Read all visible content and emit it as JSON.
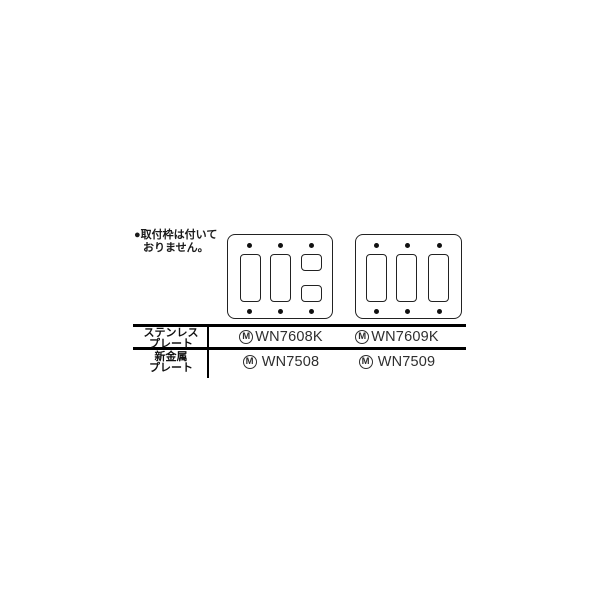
{
  "note": {
    "line1": "●取付枠は付いて",
    "line2": "おりません。"
  },
  "diagrams": {
    "left_plate": "3-gang-plate-2-large-2-small-openings",
    "right_plate": "3-gang-plate-3-large-openings"
  },
  "table": {
    "rows": [
      {
        "label_line1": "ステンレス",
        "label_line2": "プレート",
        "cells": [
          {
            "mark": "M",
            "model": "WN7608K"
          },
          {
            "mark": "M",
            "model": "WN7609K"
          }
        ]
      },
      {
        "label_line1": "新金属",
        "label_line2": "プレート",
        "cells": [
          {
            "mark": "M",
            "model": "WN7508"
          },
          {
            "mark": "M",
            "model": "WN7509"
          }
        ]
      }
    ]
  },
  "colors": {
    "background": "#ffffff",
    "rule_line": "#000000",
    "text": "#1a1a1a",
    "model_text": "#2e2e2e",
    "plate_outline": "#222222"
  }
}
